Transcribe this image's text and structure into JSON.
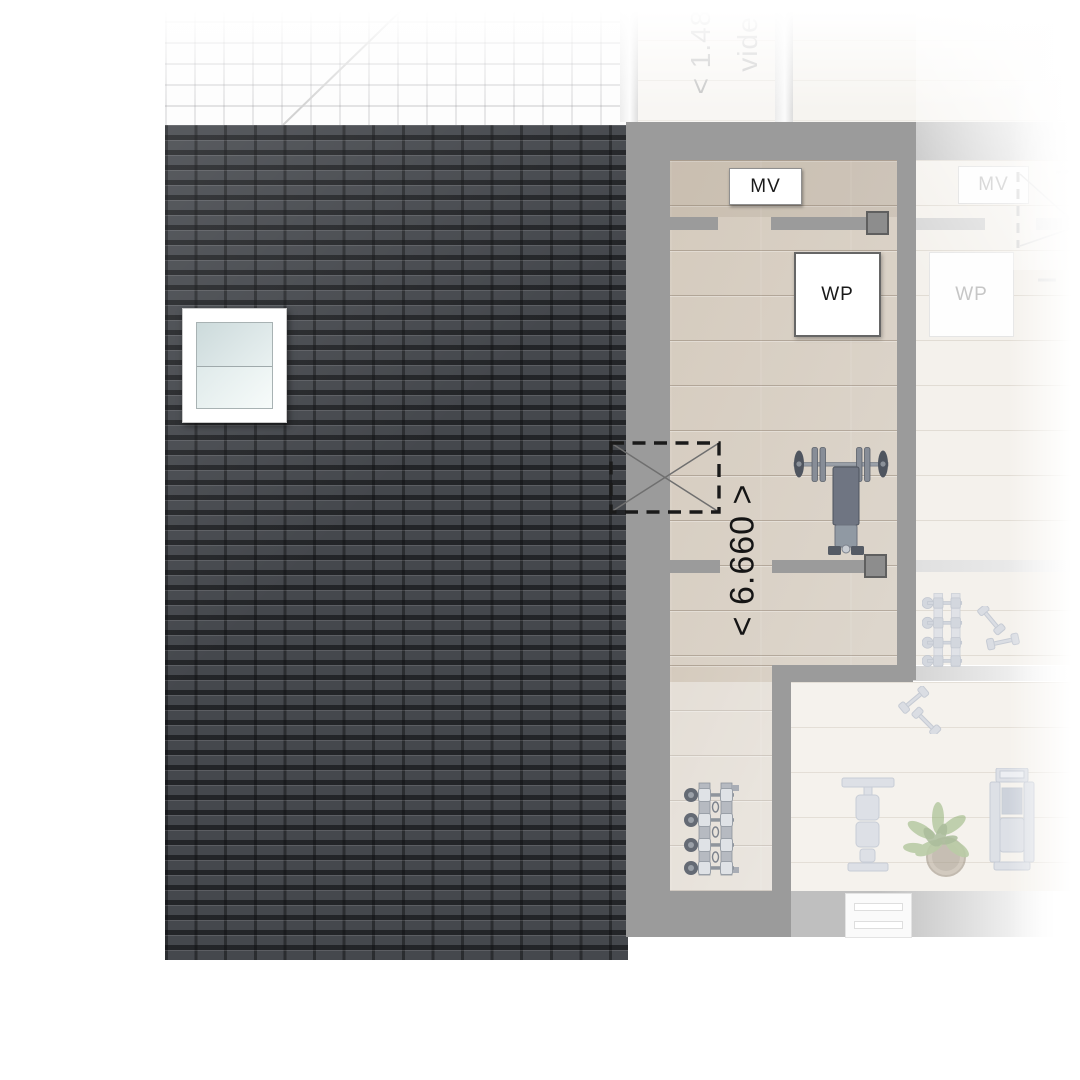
{
  "plan": {
    "labels": {
      "mv": "MV",
      "wp": "WP",
      "void": "vide",
      "mv_adjacent": "MV",
      "wp_adjacent": "WP"
    },
    "dimensions": {
      "room_length": "< 6.660 >",
      "top_width_partial": "< 1.48"
    },
    "colors": {
      "roof_tile": "#45484d",
      "roof_groove": "#26282c",
      "wall_gray": "#9b9b9b",
      "floor_wood": "#d9d1c6",
      "label_text": "#1a1a1a",
      "faded_text": "#c3c3c3",
      "plant_green": "#8aad6d"
    },
    "equipment_active": [
      "barbell-bench",
      "dumbbell-rack"
    ],
    "equipment_adjacent": [
      "dumbbell-rack",
      "loose-dumbbells",
      "weight-bench",
      "potted-plant",
      "exercise-machine",
      "skylight"
    ]
  }
}
